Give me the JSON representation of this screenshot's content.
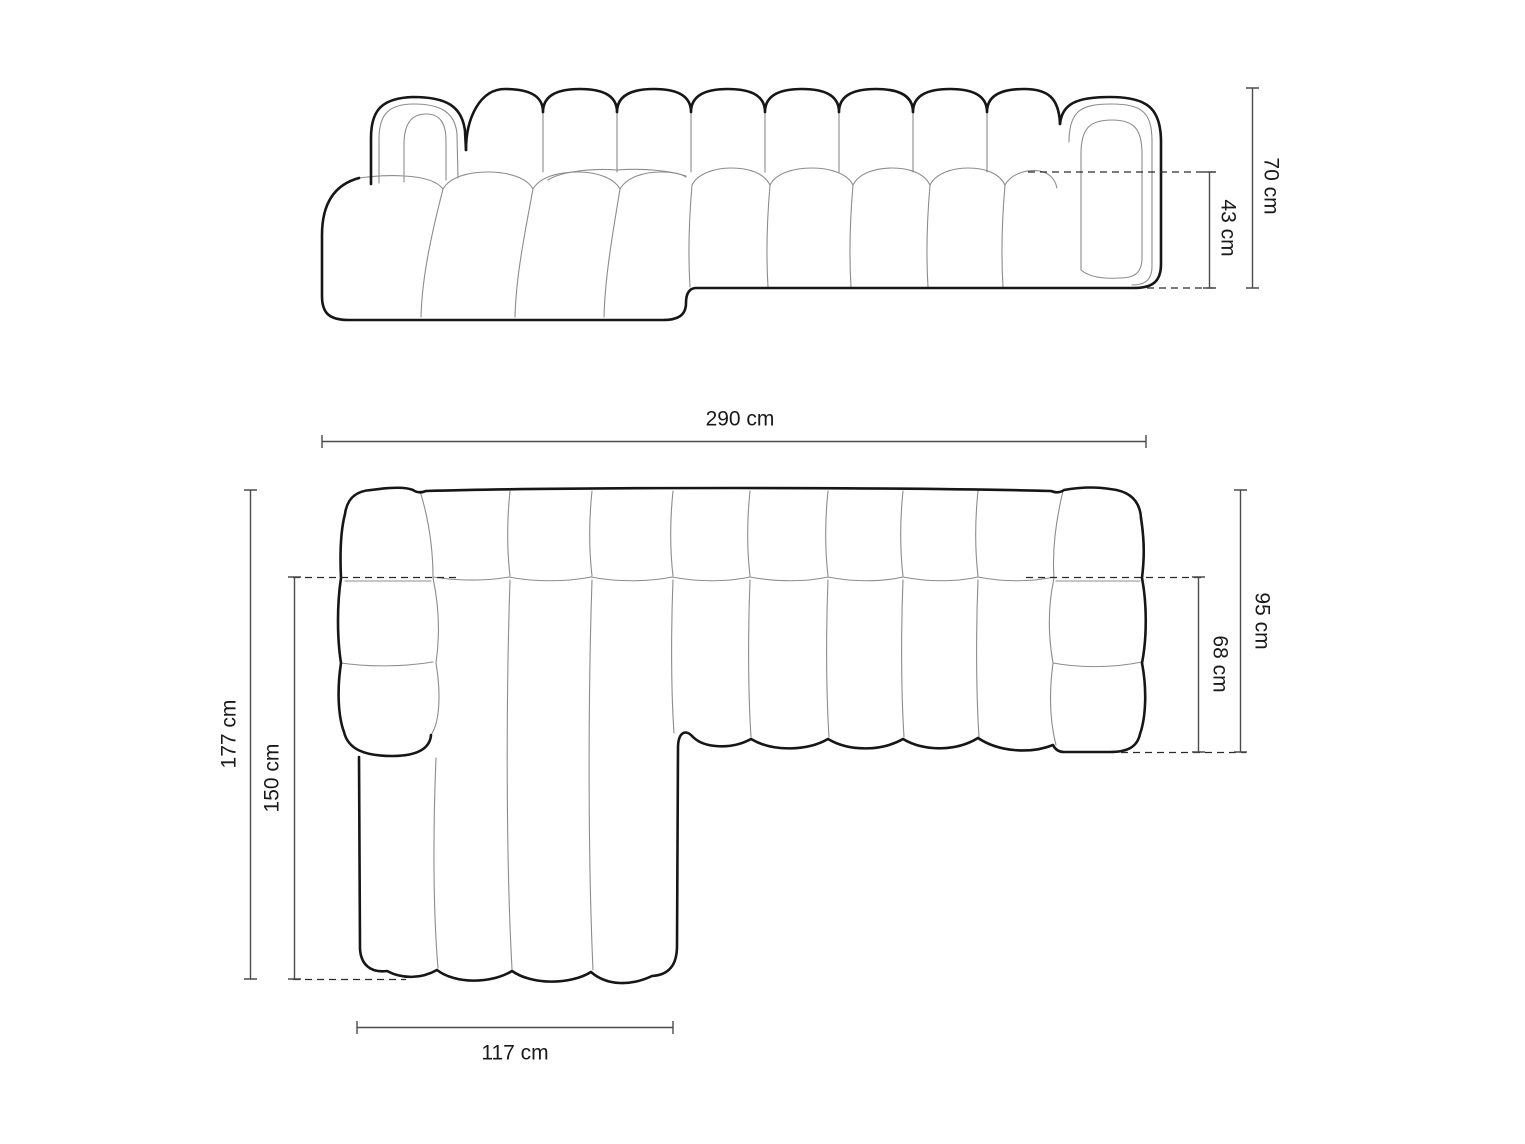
{
  "diagram": {
    "title": "Corner sofa dimension drawing (front elevation and top plan view)",
    "unit": "cm",
    "colors": {
      "background": "#ffffff",
      "outline_bold": "#161616",
      "seam_thin": "#8c8c8c",
      "dashed": "#2a2a2a",
      "dimension_line": "#4b4b4b",
      "label_text": "#1a1a1a"
    },
    "dimensions": {
      "total_height": {
        "label": "70 cm",
        "value_cm": 70,
        "view": "front"
      },
      "seat_height": {
        "label": "43 cm",
        "value_cm": 43,
        "view": "front"
      },
      "total_width": {
        "label": "290 cm",
        "value_cm": 290,
        "view": "top"
      },
      "total_depth": {
        "label": "95 cm",
        "value_cm": 95,
        "view": "top"
      },
      "seat_depth": {
        "label": "68 cm",
        "value_cm": 68,
        "view": "top"
      },
      "chaise_total_depth": {
        "label": "177 cm",
        "value_cm": 177,
        "view": "top"
      },
      "chaise_inner_depth": {
        "label": "150 cm",
        "value_cm": 150,
        "view": "top"
      },
      "chaise_width": {
        "label": "117 cm",
        "value_cm": 117,
        "view": "top"
      }
    }
  }
}
